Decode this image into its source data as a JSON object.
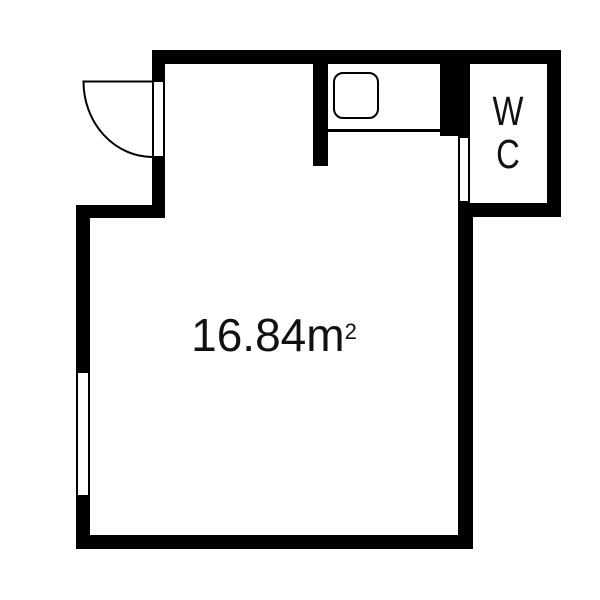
{
  "floor_plan": {
    "background_color": "#ffffff",
    "wall_color": "#000000",
    "text_color": "#111111",
    "main_room": {
      "area_value": "16.84",
      "area_unit_base": "m",
      "area_unit_exponent": "2"
    },
    "wc_room": {
      "label_line1": "W",
      "label_line2": "C"
    }
  }
}
